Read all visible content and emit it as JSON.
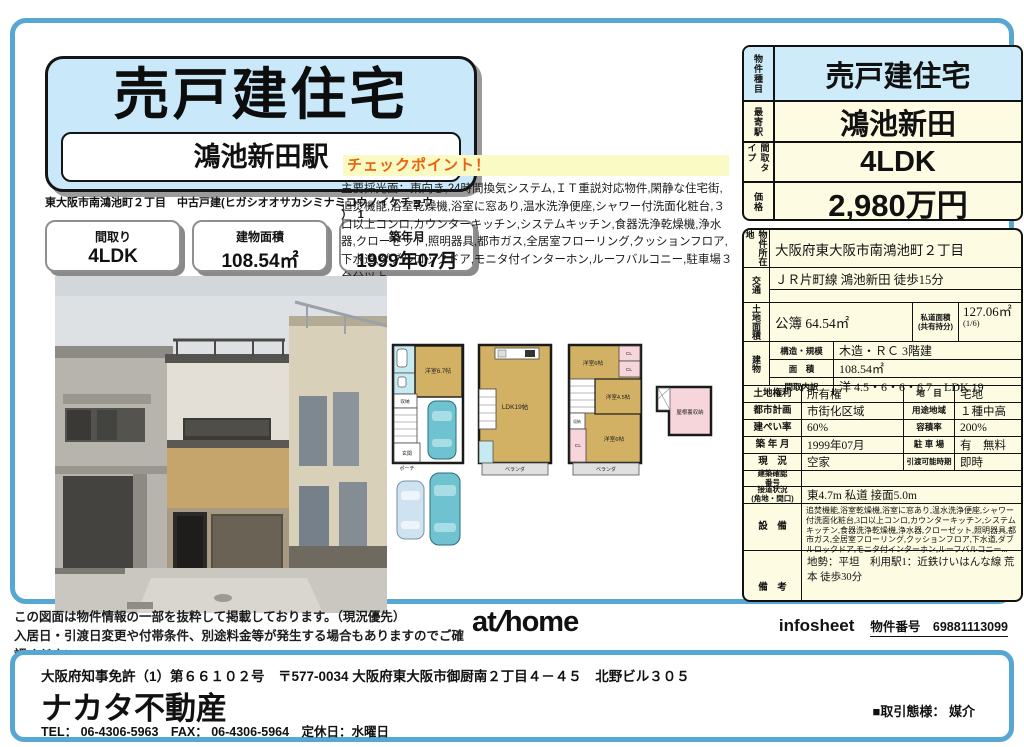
{
  "colors": {
    "frame_blue": "#57a7d3",
    "title_bg": "#c9e9fa",
    "table_cream": "#fdfce2",
    "table_blue": "#cdebf9",
    "checkpoint_orange": "#e8620c",
    "checkpoint_bg": "#fafac4",
    "plan_tan": "#d3b164",
    "plan_pink": "#f7d6db",
    "plan_blue": "#c7e9f2",
    "car_teal": "#6fc2cf"
  },
  "header": {
    "title": "売戸建住宅",
    "station": "鴻池新田駅",
    "address_line1": "東大阪市南鴻池町２丁目　中古戸建(ヒガシオオサカシミナミコウノイケチョウ",
    "address_line2": "）　1",
    "summary_boxes": [
      {
        "label": "間取り",
        "value": "4LDK"
      },
      {
        "label": "建物面積",
        "value": "108.54㎡"
      },
      {
        "label": "築年月",
        "value": "1999年07月"
      }
    ]
  },
  "checkpoint": {
    "heading": "チェックポイント！",
    "body": "主要採光面：東向き,24時間換気システム,ＩＴ重説対応物件,閑静な住宅街,追焚機能,浴室乾燥機,浴室に窓あり,温水洗浄便座,シャワー付洗面化粧台,３口以上コンロ,カウンターキッチン,システムキッチン,食器洗浄乾燥機,浄水器,クローゼット,照明器具,都市ガス,全居室フローリング,クッションフロア,下水道,ダブルロックドア,モニタ付インターホン,ルーフバルコニー,駐車場３台分以上"
  },
  "summary_table": {
    "rows": [
      {
        "label": "物件種目",
        "value": "売戸建住宅"
      },
      {
        "label": "最寄駅",
        "value": "鴻池新田"
      },
      {
        "label": "間取タイプ",
        "value": "4LDK"
      },
      {
        "label": "価格",
        "value": "2,980万円"
      }
    ]
  },
  "detail_table": {
    "location_label": "物件所在地",
    "location": "大阪府東大阪市南鴻池町２丁目",
    "access_label": "交通",
    "access": "ＪＲ片町線 鴻池新田 徒歩15分",
    "land_label": "土地面積",
    "land_value": "公簿 64.54㎡",
    "private_road_label1": "私道面積",
    "private_road_label2": "(共有持分)",
    "private_road_value": "127.06㎡",
    "private_road_share": "(1/6)",
    "building_label": "建物",
    "building_rows": [
      {
        "label": "構造・規模",
        "value": "木造・ＲＣ 3階建"
      },
      {
        "label": "面　積",
        "value": "108.54㎡"
      },
      {
        "label": "間取内訳",
        "value": "洋 4.5・6・6・6.7　LDK 19"
      }
    ],
    "pairs": [
      {
        "l1": "土地権利",
        "v1": "所有権",
        "l2": "地　目",
        "v2": "宅地"
      },
      {
        "l1": "都市計画",
        "v1": "市街化区域",
        "l2": "用途地域",
        "v2": "１種中高"
      },
      {
        "l1": "建ぺい率",
        "v1": "60%",
        "l2": "容積率",
        "v2": "200%"
      },
      {
        "l1": "築 年 月",
        "v1": "1999年07月",
        "l2": "駐 車 場",
        "v2": "有　無料"
      },
      {
        "l1": "現　況",
        "v1": "空家",
        "l2": "引渡可能時期",
        "v2": "即時"
      }
    ],
    "cert_label1": "建築確認",
    "cert_label2": "番号",
    "cert_value": "",
    "road_label1": "接道状況",
    "road_label2": "(角地・間口)",
    "road_value": "東4.7m 私道 接面5.0m",
    "equipment_label": "設　備",
    "equipment": "追焚機能,浴室乾燥機,浴室に窓あり,温水洗浄便座,シャワー付洗面化粧台,3口以上コンロ,カウンターキッチン,システムキッチン,食器洗浄乾燥機,浄水器,クローゼット,照明器具,都市ガス,全居室フローリング,クッションフロア,下水道,ダブルロックドア,モニタ付インターホン,ルーフバルコニー...",
    "remarks_label": "備　考",
    "remarks": "地勢：平坦　利用駅1：近鉄けいはんな線 荒本 徒歩30分"
  },
  "floorplan": {
    "f1_room": "洋室6.7帖",
    "f1_storage": "収納",
    "f1_entry": "玄関",
    "f1_porch": "ポーチ",
    "f2_ldk": "LDK19帖",
    "f2_balcony": "ベランダ",
    "f3_room_top": "洋室6帖",
    "f3_cl1": "CL",
    "f3_cl2": "CL",
    "f3_room_mid": "洋室4.5帖",
    "f3_storage": "収納",
    "f3_cl3": "CL",
    "f3_room_btm": "洋室6帖",
    "f3_balcony": "ベランダ",
    "attic": "屋根裏収納"
  },
  "footer": {
    "disclaimer1": "この図面は物件情報の一部を抜粋して掲載しております。（現況優先）",
    "disclaimer2": "入居日・引渡日変更や付帯条件、別途料金等が発生する場合もありますのでご確認ください。",
    "logo_at": "at",
    "logo_slash": "/",
    "logo_home": "home",
    "infosheet": "infosheet",
    "property_no": "物件番号　69881113099"
  },
  "company": {
    "license": "大阪府知事免許（1）第６６１０２号　〒577-0034 大阪府東大阪市御厨南２丁目４－４５　北野ビル３０５",
    "name": "ナカタ不動産",
    "tel_line": "TEL： 06-4306-5963　FAX： 06-4306-5964　定休日：水曜日",
    "transaction": "■取引態様： 媒介"
  }
}
